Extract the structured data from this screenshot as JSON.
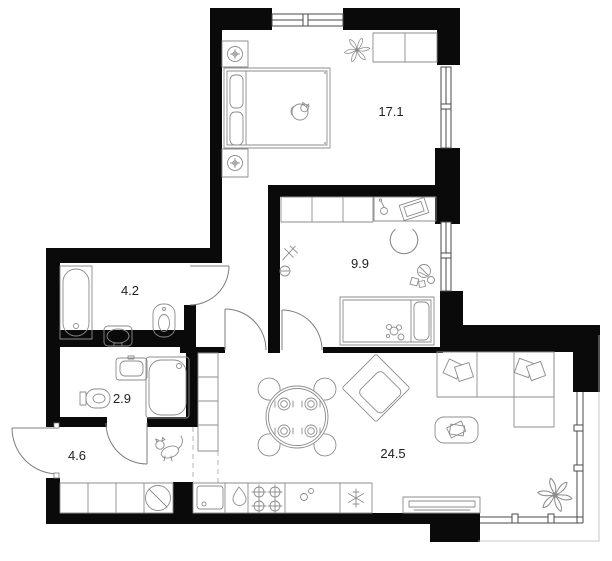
{
  "plan": {
    "type": "apartment-floor-plan",
    "colors": {
      "wall": "#0a0a0a",
      "furniture_line": "#8c8c8c",
      "window_line": "#4a4a4a",
      "background": "#ffffff",
      "label": "#222222"
    },
    "rooms": [
      {
        "name": "bedroom",
        "area_label": "17.1"
      },
      {
        "name": "kids-room",
        "area_label": "9.9"
      },
      {
        "name": "bathroom",
        "area_label": "4.2"
      },
      {
        "name": "shower-wc",
        "area_label": "2.9"
      },
      {
        "name": "hallway",
        "area_label": "4.6"
      },
      {
        "name": "living-kitchen",
        "area_label": "24.5"
      }
    ],
    "fixtures": {
      "bedroom": [
        "double-bed",
        "pillows",
        "nightstand-with-lamp",
        "nightstand-with-lamp",
        "wardrobe",
        "plant",
        "cat"
      ],
      "kids_room": [
        "wardrobe",
        "desk",
        "laptop",
        "desk-lamp",
        "desk-chair",
        "single-bed",
        "teddy-bear",
        "toy-ball",
        "toy-plane",
        "toy-blocks"
      ],
      "bathroom": [
        "bathtub",
        "washbasin",
        "toilet"
      ],
      "shower_wc": [
        "toilet",
        "washbasin",
        "shower-cabin"
      ],
      "hallway": [
        "cat",
        "built-in-closet",
        "entrance-door"
      ],
      "living_kitchen": [
        "kitchen-counter",
        "washing-machine",
        "kitchen-sink",
        "kettle",
        "stove",
        "fridge",
        "dining-table",
        "dining-chairs",
        "armchair",
        "corner-sofa",
        "cushions",
        "coffee-table",
        "tv-console",
        "plant",
        "panoramic-window"
      ]
    }
  }
}
